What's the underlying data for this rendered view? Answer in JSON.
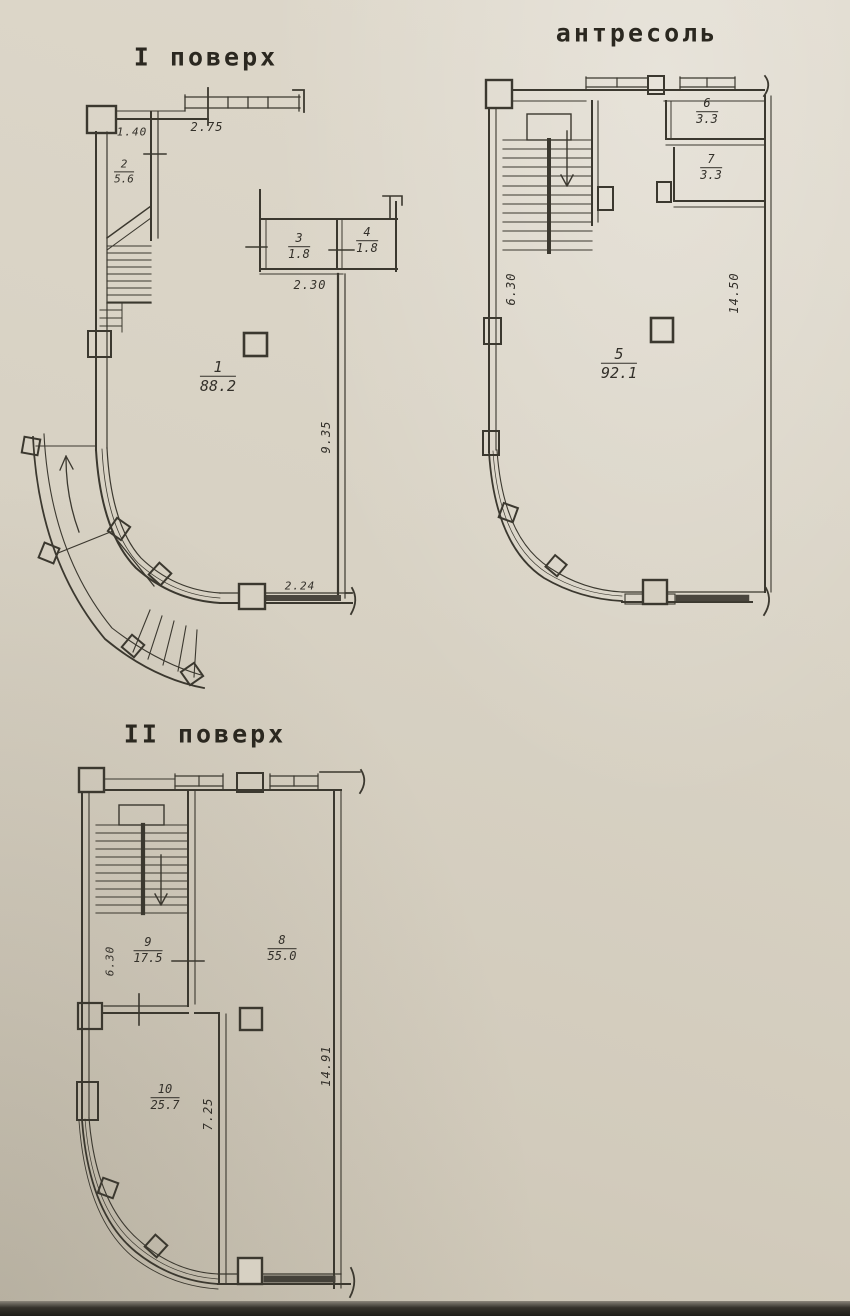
{
  "colors": {
    "paper": "#d8d2c4",
    "ink": "#3b382f"
  },
  "plans": {
    "first": {
      "title": "I поверх",
      "rooms": {
        "r1": {
          "num": "1",
          "area": "88.2"
        },
        "r2": {
          "num": "2",
          "area": "5.6"
        },
        "r3": {
          "num": "3",
          "area": "1.8"
        },
        "r4": {
          "num": "4",
          "area": "1.8"
        }
      },
      "dims": {
        "d_top_left": "1.40",
        "d_top": "2.75",
        "d_mid": "2.30",
        "d_right_v": "9.35",
        "d_bottom": "2.24"
      }
    },
    "mezzanine": {
      "title": "антресоль",
      "rooms": {
        "r5": {
          "num": "5",
          "area": "92.1"
        },
        "r6": {
          "num": "6",
          "area": "3.3"
        },
        "r7": {
          "num": "7",
          "area": "3.3"
        }
      },
      "dims": {
        "d_left_v": "6.30",
        "d_right_v": "14.50"
      }
    },
    "second": {
      "title": "II поверх",
      "rooms": {
        "r8": {
          "num": "8",
          "area": "55.0"
        },
        "r9": {
          "num": "9",
          "area": "17.5"
        },
        "r10": {
          "num": "10",
          "area": "25.7"
        }
      },
      "dims": {
        "d_left_v": "6.30",
        "d_mid_v": "7.25",
        "d_right_v": "14.91"
      }
    }
  }
}
